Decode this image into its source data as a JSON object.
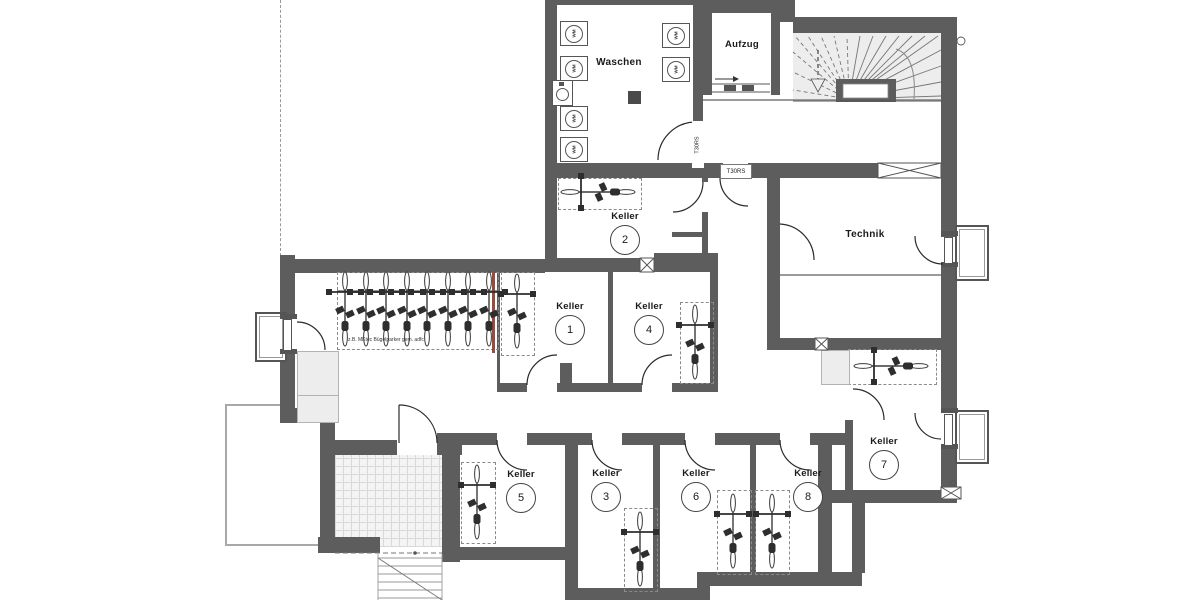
{
  "plan": {
    "rooms": {
      "waschen": {
        "label": "Waschen"
      },
      "aufzug": {
        "label": "Aufzug"
      },
      "technik": {
        "label": "Technik"
      },
      "keller_units": [
        {
          "label": "Keller",
          "number": "1"
        },
        {
          "label": "Keller",
          "number": "2"
        },
        {
          "label": "Keller",
          "number": "3"
        },
        {
          "label": "Keller",
          "number": "4"
        },
        {
          "label": "Keller",
          "number": "5"
        },
        {
          "label": "Keller",
          "number": "6"
        },
        {
          "label": "Keller",
          "number": "7"
        },
        {
          "label": "Keller",
          "number": "8"
        }
      ]
    },
    "annotations": {
      "fire_door_rating": "T30RS",
      "washing_machine": "WM",
      "bike_parking_note": "z.B. MKtec Bügelparker gem. adfc"
    },
    "colors": {
      "wall": "#5d5d5d",
      "line": "#2b2b2b",
      "fire_line_red": "#9a4b3c"
    }
  }
}
